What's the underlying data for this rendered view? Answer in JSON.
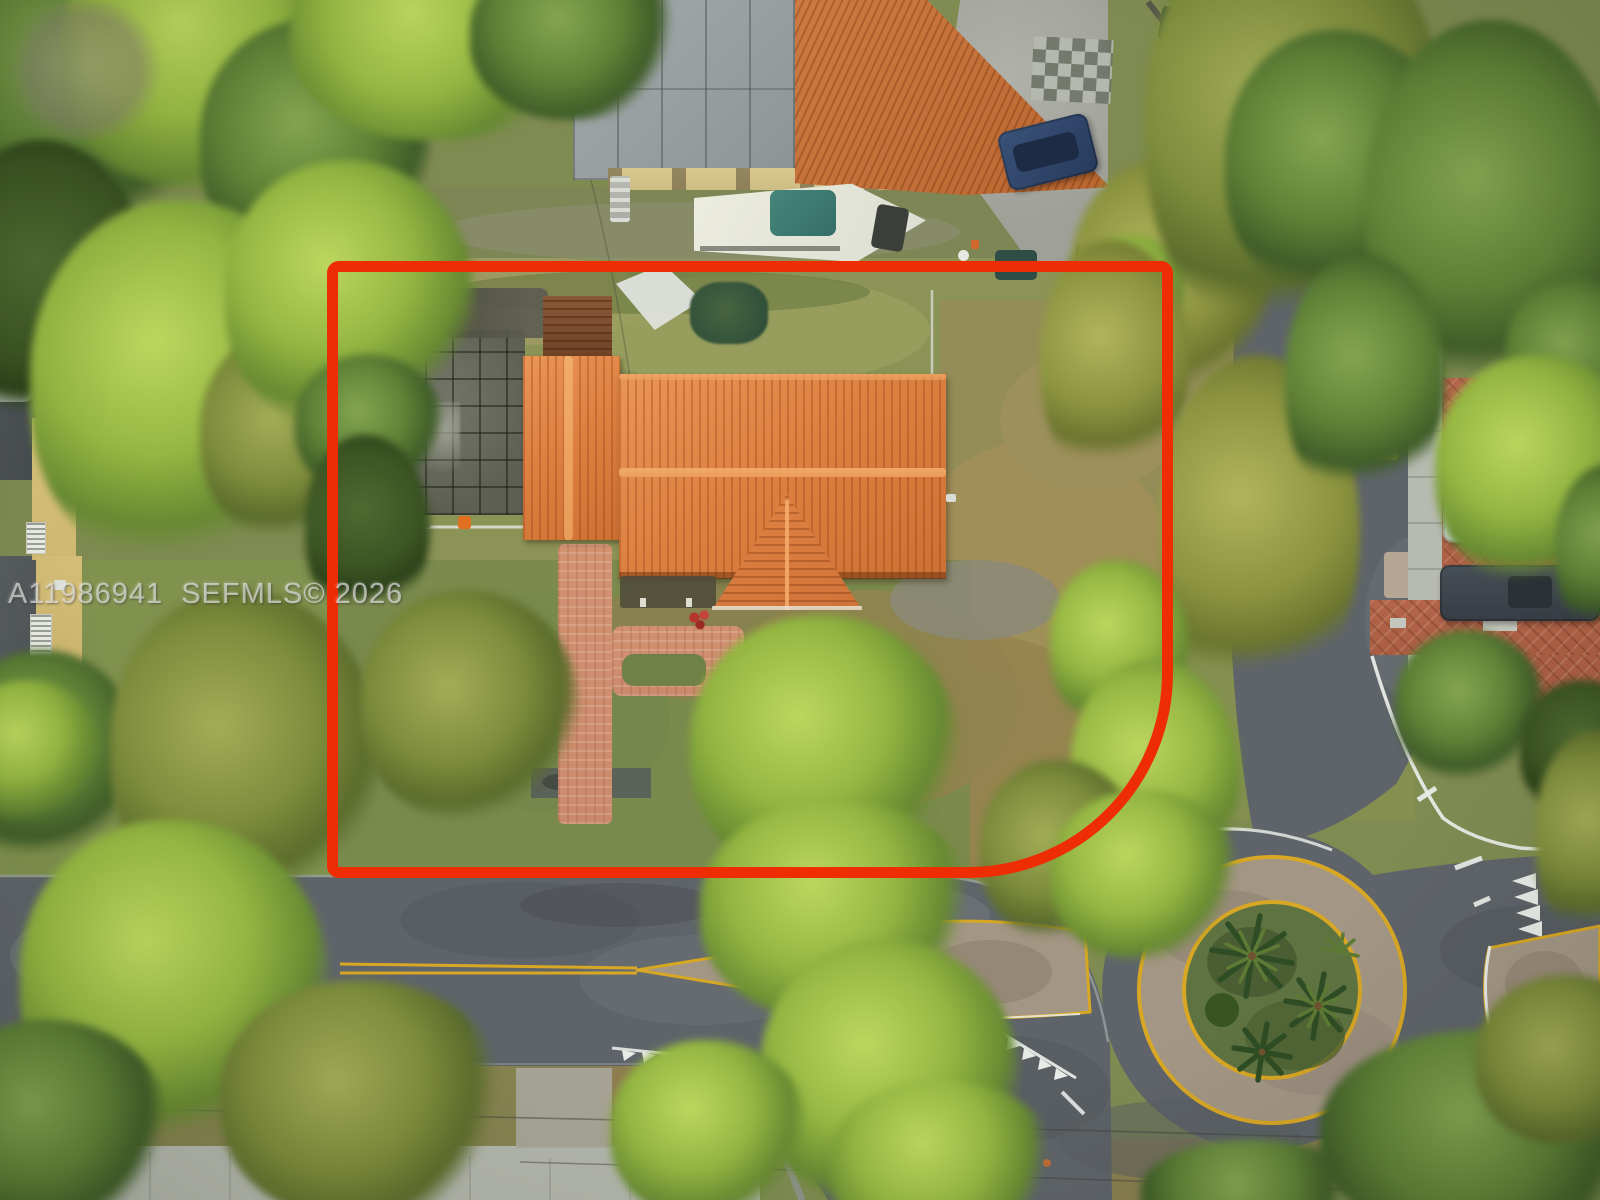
{
  "meta": {
    "type": "aerial-drone-photograph",
    "subject": "Top-down view of a corner-lot single-family home outlined with a red property-boundary overlay",
    "setting": "Residential neighborhood with tree canopy, corner traffic circle with palms, and parked vehicles"
  },
  "watermark": {
    "text": "A11986941  SEFMLS© 2026"
  },
  "colors": {
    "boundary_red": "#ee2d04",
    "roof_tile": "#dd8142",
    "neighbor_roof": "#b96630",
    "walkway_paver": "#cb8a6c",
    "brick_drive": "#b4654a",
    "asphalt": "#5f646a",
    "concrete": "#b2b5ab",
    "marking_yellow": "#d8a724",
    "marking_white": "#e9ebe7",
    "grass": "#7f8b51",
    "dry_grass": "#9c8c59",
    "roundabout_paver": "#a39684",
    "palm_green": "#2f4d24",
    "patio_gray": "#5d5f52"
  },
  "scene": {
    "property_boundary": "red rectangular lot outline with large rounded corner at the street intersection",
    "subject_house": "terracotta barrel-tile roof, L-shaped plan with front gable and rear wing",
    "features": [
      "salmon paver walkway from house to street",
      "front-door paver pad with planting cutout",
      "rear concrete patio with grid joints",
      "dry brown lawn patches",
      "double-yellow street centerline with splitter islands",
      "traffic circle with palm planting",
      "white chevron and dash road markings",
      "neighboring flat-roof and tile-roof homes",
      "boat on trailer in neighboring yard",
      "parked cars on brick driveway",
      "overhead power lines and utility pole"
    ]
  }
}
